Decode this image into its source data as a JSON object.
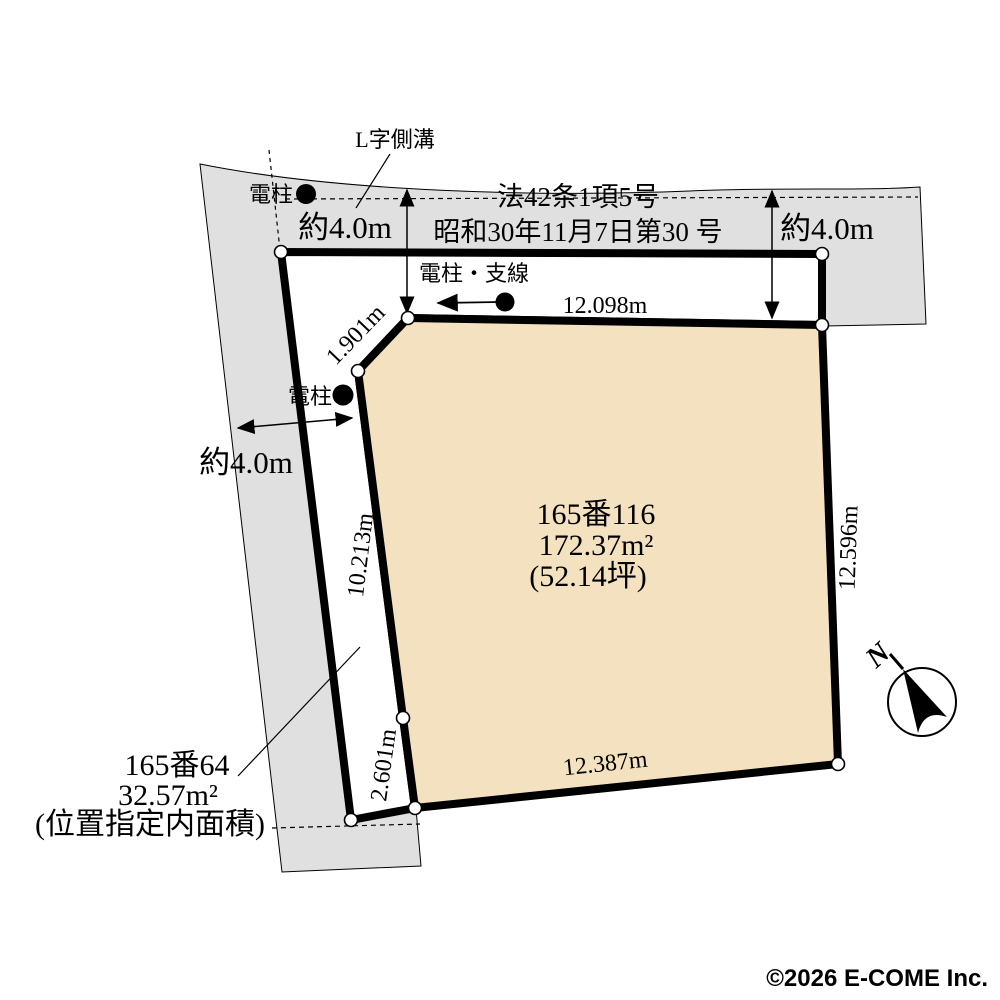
{
  "plan": {
    "labels": {
      "gutter": "L字側溝",
      "pole_top": "電柱",
      "pole_mid": "電柱",
      "pole_wire": "電柱・支線",
      "law_line1": "法42条1項5号",
      "law_line2": "昭和30年11月7日第30 号",
      "width_top_left": "約4.0m",
      "width_top_right": "約4.0m",
      "width_left": "約4.0m",
      "north": "N"
    },
    "dims": {
      "top": "12.098m",
      "right": "12.596m",
      "bottom": "12.387m",
      "left": "10.213m",
      "left_lower": "2.601m",
      "chamfer": "1.901m"
    },
    "main_parcel": {
      "lot": "165番116",
      "area": "172.37m²",
      "tsubo": "(52.14坪)"
    },
    "road_parcel": {
      "lot": "165番64",
      "area": "32.57m²",
      "note": "(位置指定内面積)"
    },
    "colors": {
      "parcel_fill": "#f3e1bf",
      "road_fill": "#e0e0e0",
      "line": "#000000",
      "copyright_gray": "#8a8a8a"
    }
  },
  "footer": {
    "copyright": "©2026 E-COME Inc."
  }
}
